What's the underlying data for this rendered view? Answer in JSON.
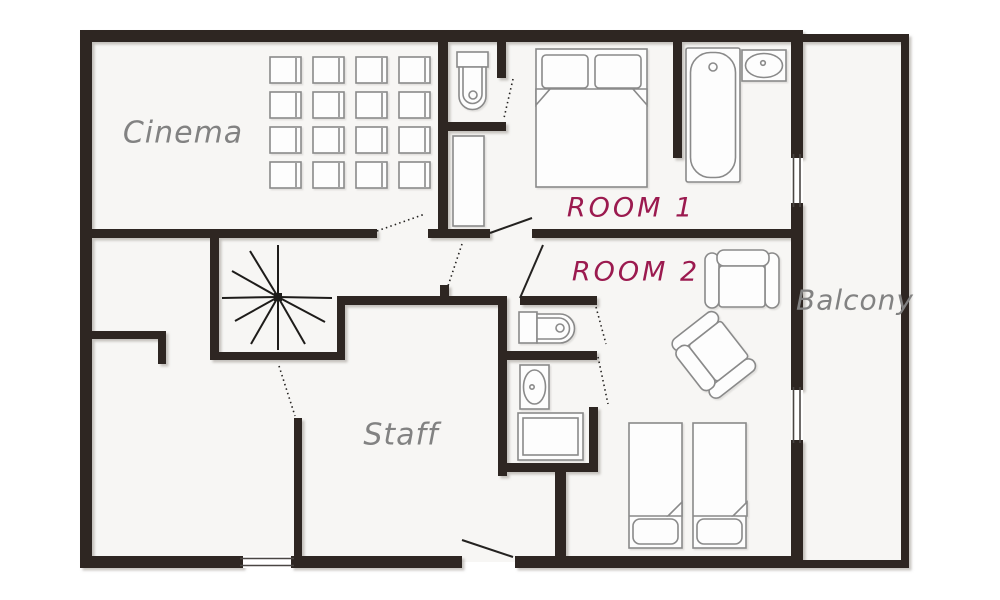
{
  "title": "Chalet floor plan",
  "colors": {
    "background": "#ffffff",
    "floor": "#f7f6f4",
    "walls": "#2d2724",
    "furniture_outline": "#8a8a8a",
    "stairs_lines": "#1e1c1a",
    "room_label_gray": "#828282",
    "room_label_accent": "#9b1a4f"
  },
  "rooms": {
    "cinema": {
      "label": "Cinema"
    },
    "room1": {
      "label": "ROOM 1"
    },
    "room2": {
      "label": "ROOM 2"
    },
    "staff": {
      "label": "Staff"
    },
    "balcony": {
      "label": "Balcony"
    }
  },
  "furniture": {
    "cinema_seats": {
      "rows": 4,
      "cols": 4,
      "count": 16
    },
    "items": [
      "spiral-staircase",
      "toilet-top",
      "wardrobe",
      "double-bed",
      "bathtub",
      "washbasin-top",
      "toilet-mid",
      "washbasin-mid",
      "shower-tray",
      "armchair-upright",
      "armchair-rotated",
      "single-bed-left",
      "single-bed-right"
    ]
  },
  "windows": {
    "count": 3
  },
  "doors": {
    "count": 9
  }
}
